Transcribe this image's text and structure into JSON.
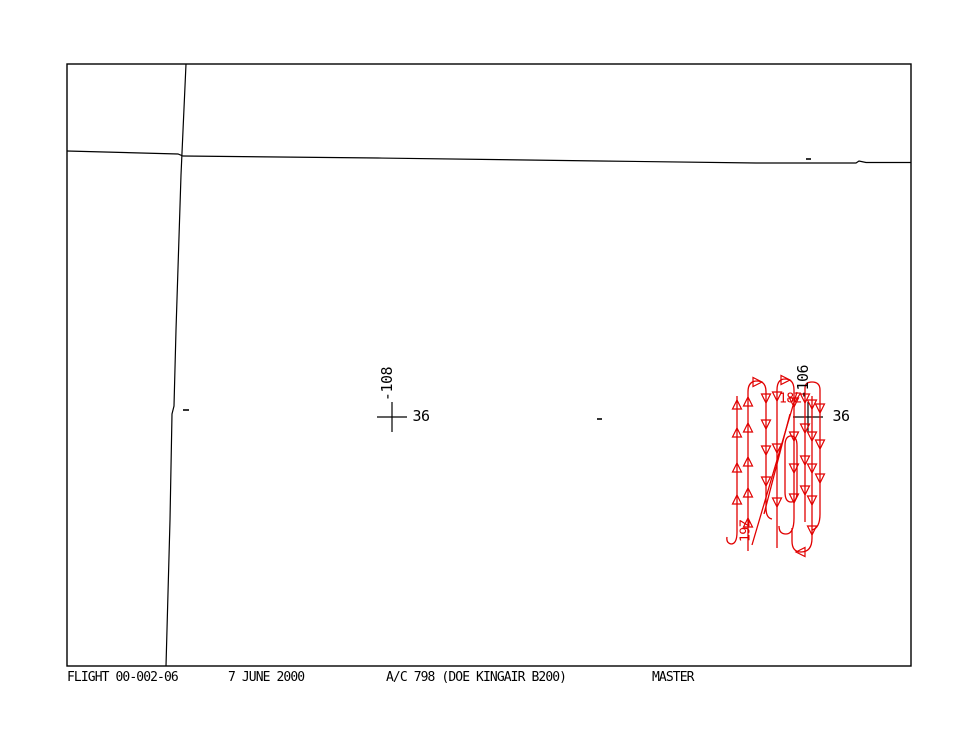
{
  "display": {
    "background": "#ffffff",
    "map_color": "#000000",
    "track_color": "#e10000"
  },
  "map": {
    "frame": {
      "x": 67,
      "y": 64,
      "w": 844,
      "h": 602
    },
    "boundaries": [
      "M67,151 L178,154 L183,156 L378,158 L600,161 L756,163 L856,163 L859,161 L866,162.5 L911,162.5",
      "M186,64 L181,175 L176,330 L174,406 L172,414 L170,520 L166,666"
    ],
    "ticks": [
      {
        "x": 183,
        "y": 410,
        "len": 6
      },
      {
        "x": 597,
        "y": 419,
        "len": 5
      },
      {
        "x": 806,
        "y": 159,
        "len": 5
      }
    ],
    "crosses": [
      {
        "x": 392,
        "y": 417,
        "arm": 15
      },
      {
        "x": 808,
        "y": 417,
        "arm": 15
      }
    ],
    "labels": [
      {
        "text": "-108",
        "x": 387,
        "y": 384,
        "rotate": -90
      },
      {
        "text": "36",
        "x": 421,
        "y": 416,
        "rotate": 0
      },
      {
        "text": "-106",
        "x": 803,
        "y": 382,
        "rotate": -90
      },
      {
        "text": "36",
        "x": 841,
        "y": 416,
        "rotate": 0
      }
    ]
  },
  "track": {
    "paths": [
      "M737,396 L737,532 Q737,544 731,544 Q726,543 727,537",
      "M748,551 L748,392 Q748,381 757,381 Q766,381 766,392 L766,508 Q766,518 772,519",
      "M777,548 L777,390 Q777,379 785,379 Q794,379 794,390 L794,518 Q794,534 786,534 Q779,534 779,526",
      "M812,396 L812,538 Q812,552 801,552 Q792,552 792,541 L792,528",
      "M805,522 L805,388 Q805,382 812,382 Q820,382 820,390 L820,514 Q820,528 812,530",
      "M785,446 Q785,436 791,436 Q797,436 797,446 L797,492 Q797,502 791,502 Q785,502 785,492 Z",
      "M752,545 L797,392",
      "M764,514 L790,414"
    ],
    "markers": [
      {
        "dir": "up",
        "x": 737,
        "y": 405
      },
      {
        "dir": "up",
        "x": 737,
        "y": 433
      },
      {
        "dir": "up",
        "x": 737,
        "y": 468
      },
      {
        "dir": "up",
        "x": 737,
        "y": 500
      },
      {
        "dir": "up",
        "x": 748,
        "y": 402
      },
      {
        "dir": "up",
        "x": 748,
        "y": 428
      },
      {
        "dir": "up",
        "x": 748,
        "y": 462
      },
      {
        "dir": "up",
        "x": 748,
        "y": 493
      },
      {
        "dir": "up",
        "x": 748,
        "y": 523
      },
      {
        "dir": "down",
        "x": 766,
        "y": 398
      },
      {
        "dir": "down",
        "x": 766,
        "y": 424
      },
      {
        "dir": "down",
        "x": 766,
        "y": 450
      },
      {
        "dir": "down",
        "x": 766,
        "y": 481
      },
      {
        "dir": "down",
        "x": 777,
        "y": 396
      },
      {
        "dir": "down",
        "x": 777,
        "y": 448
      },
      {
        "dir": "down",
        "x": 777,
        "y": 502
      },
      {
        "dir": "down",
        "x": 794,
        "y": 402
      },
      {
        "dir": "down",
        "x": 794,
        "y": 436
      },
      {
        "dir": "down",
        "x": 794,
        "y": 468
      },
      {
        "dir": "down",
        "x": 794,
        "y": 498
      },
      {
        "dir": "down",
        "x": 805,
        "y": 398
      },
      {
        "dir": "down",
        "x": 805,
        "y": 428
      },
      {
        "dir": "down",
        "x": 805,
        "y": 460
      },
      {
        "dir": "down",
        "x": 805,
        "y": 490
      },
      {
        "dir": "down",
        "x": 812,
        "y": 404
      },
      {
        "dir": "down",
        "x": 812,
        "y": 436
      },
      {
        "dir": "down",
        "x": 812,
        "y": 468
      },
      {
        "dir": "down",
        "x": 812,
        "y": 500
      },
      {
        "dir": "down",
        "x": 812,
        "y": 530
      },
      {
        "dir": "down",
        "x": 820,
        "y": 408
      },
      {
        "dir": "down",
        "x": 820,
        "y": 444
      },
      {
        "dir": "down",
        "x": 820,
        "y": 478
      },
      {
        "dir": "right",
        "x": 757,
        "y": 382
      },
      {
        "dir": "right",
        "x": 785,
        "y": 380
      },
      {
        "dir": "left",
        "x": 801,
        "y": 552
      }
    ],
    "labels": [
      {
        "text": "18Z",
        "x": 790,
        "y": 399,
        "rotate": 0
      },
      {
        "text": "19Z",
        "x": 746,
        "y": 531,
        "rotate": -90
      }
    ]
  },
  "status_bar": {
    "flight": "FLIGHT 00-002-06",
    "date": "7 JUNE 2000",
    "aircraft": "A/C 798 (DOE KINGAIR B200)",
    "mode": "MASTER"
  }
}
